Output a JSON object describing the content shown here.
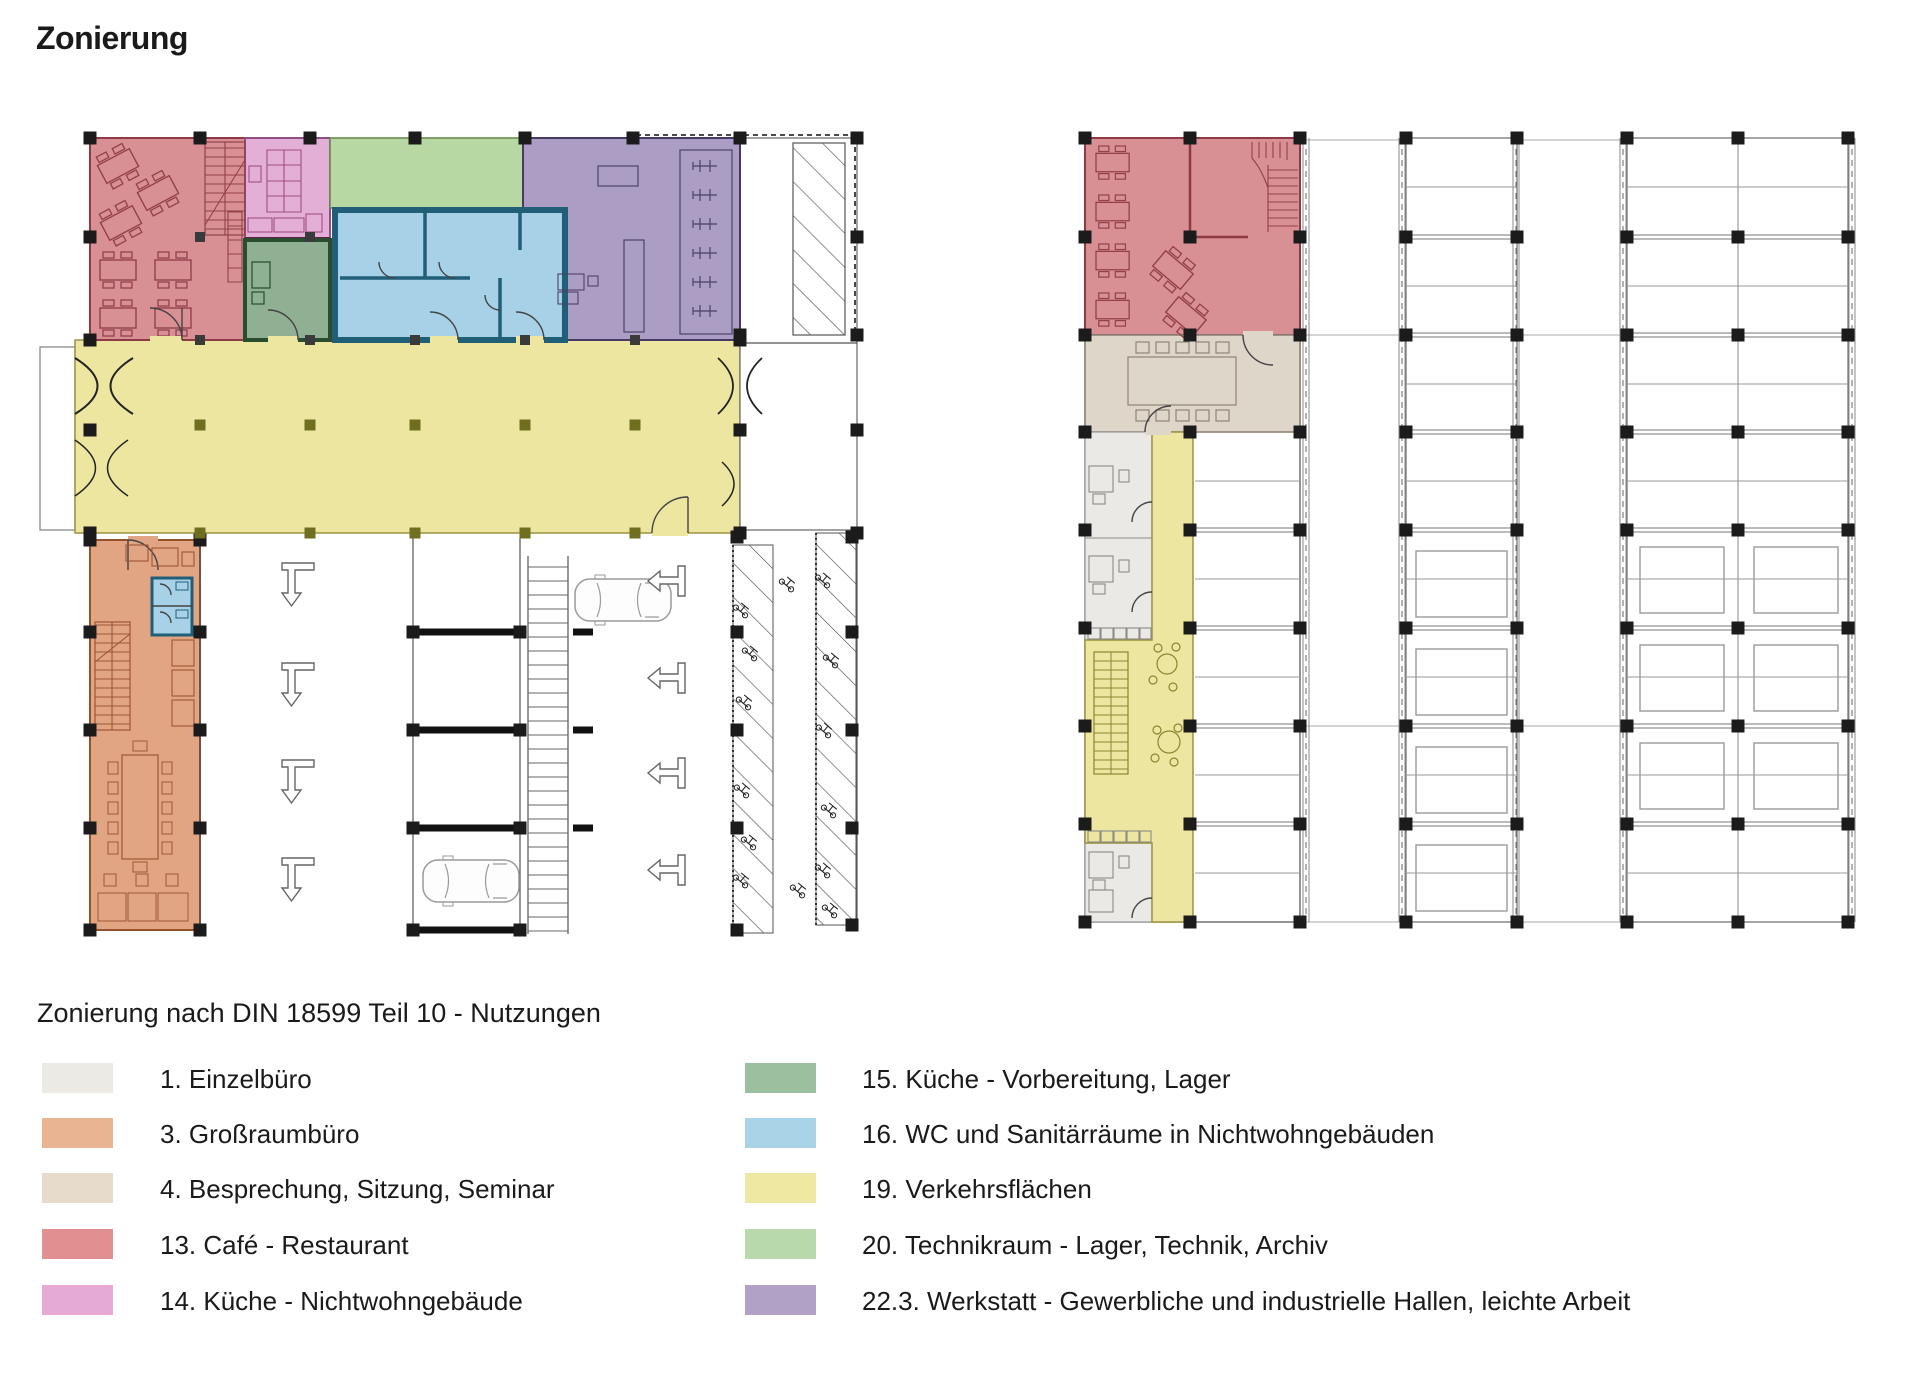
{
  "title": "Zonierung",
  "subtitle": "Zonierung nach DIN 18599 Teil 10 - Nutzungen",
  "legend": {
    "left_column": [
      {
        "text": "1. Einzelbüro",
        "color": "#ECEAE5"
      },
      {
        "text": "3. Großraumbüro",
        "color": "#E8B492"
      },
      {
        "text": "4. Besprechung, Sitzung, Seminar",
        "color": "#E7DCCB"
      },
      {
        "text": "13. Café - Restaurant",
        "color": "#E09090"
      },
      {
        "text": "14. Küche - Nichtwohngebäude",
        "color": "#E5ABD6"
      }
    ],
    "right_column": [
      {
        "text": "15. Küche - Vorbereitung, Lager",
        "color": "#9CBF9F"
      },
      {
        "text": "16. WC und Sanitärräume in Nichtwohngebäuden",
        "color": "#A9D3E7"
      },
      {
        "text": "19. Verkehrsflächen",
        "color": "#EFE8A2"
      },
      {
        "text": "20. Technikraum - Lager, Technik, Archiv",
        "color": "#B7D9AB"
      },
      {
        "text": "22.3. Werkstatt - Gewerbliche und industrielle Hallen, leichte Arbeit",
        "color": "#B2A1C7"
      }
    ]
  },
  "zone_colors": {
    "einzelbuero": "#EBE9E5",
    "grossraumbuero": "#E2A584",
    "besprechung": "#DED6C9",
    "cafe_restaurant": "#D99094",
    "kueche_nichtwohngebaeude": "#E3AFD7",
    "kueche_vorbereitung": "#8FB092",
    "wc_sanitaer": "#A6D1E6",
    "verkehrsflaechen": "#EDE6A0",
    "technikraum": "#B8D8A3",
    "werkstatt": "#AC9DC5"
  }
}
